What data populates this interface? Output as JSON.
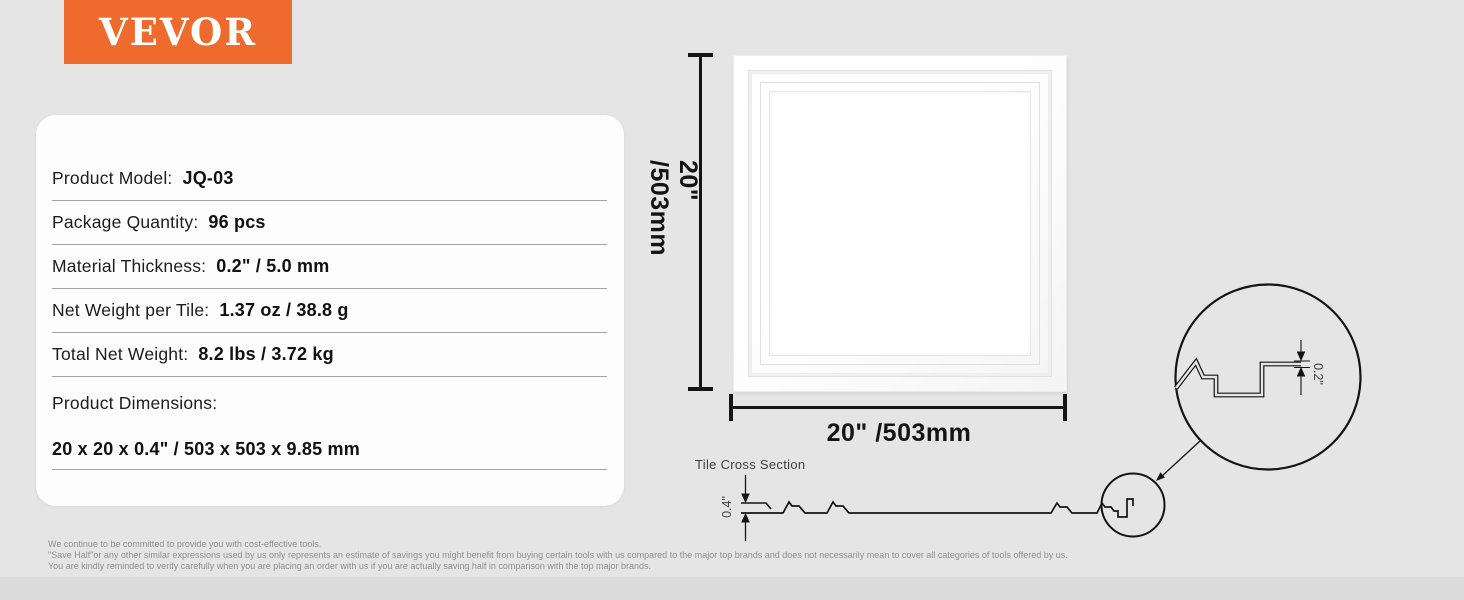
{
  "brand": {
    "logo_text": "VEVOR",
    "logo_bg": "#ee6b2d",
    "logo_color": "#ffffff"
  },
  "spec_card": {
    "rows": [
      {
        "label": "Product Model:",
        "value": "JQ-03"
      },
      {
        "label": "Package Quantity:",
        "value": "96 pcs"
      },
      {
        "label": "Material Thickness:",
        "value": "0.2\" / 5.0 mm"
      },
      {
        "label": "Net Weight per Tile:",
        "value": "1.37 oz / 38.8 g"
      },
      {
        "label": "Total Net Weight:",
        "value": "8.2 lbs / 3.72 kg"
      }
    ],
    "dimensions": {
      "label": "Product Dimensions:",
      "value": "20 x 20 x 0.4\" / 503 x 503 x 9.85 mm"
    }
  },
  "diagram": {
    "height_label": "20\" /503mm",
    "width_label": "20\" /503mm",
    "cross_section": {
      "title": "Tile Cross Section",
      "thickness_label": "0.4\"",
      "detail_thickness_label": "0.2\""
    }
  },
  "footer": {
    "lines": [
      "We continue to be committed to provide you with cost-effective tools.",
      "\"Save Half\"or any other similar expressions used by us only represents an estimate of savings you might benefit from buying certain tools with us compared to the major top brands and does not necessarily mean to cover all categories of tools offered by us.",
      "You are kindly reminded to verify carefully when you are placing an order with us if you are actually saving half in comparison with the top major brands."
    ]
  }
}
